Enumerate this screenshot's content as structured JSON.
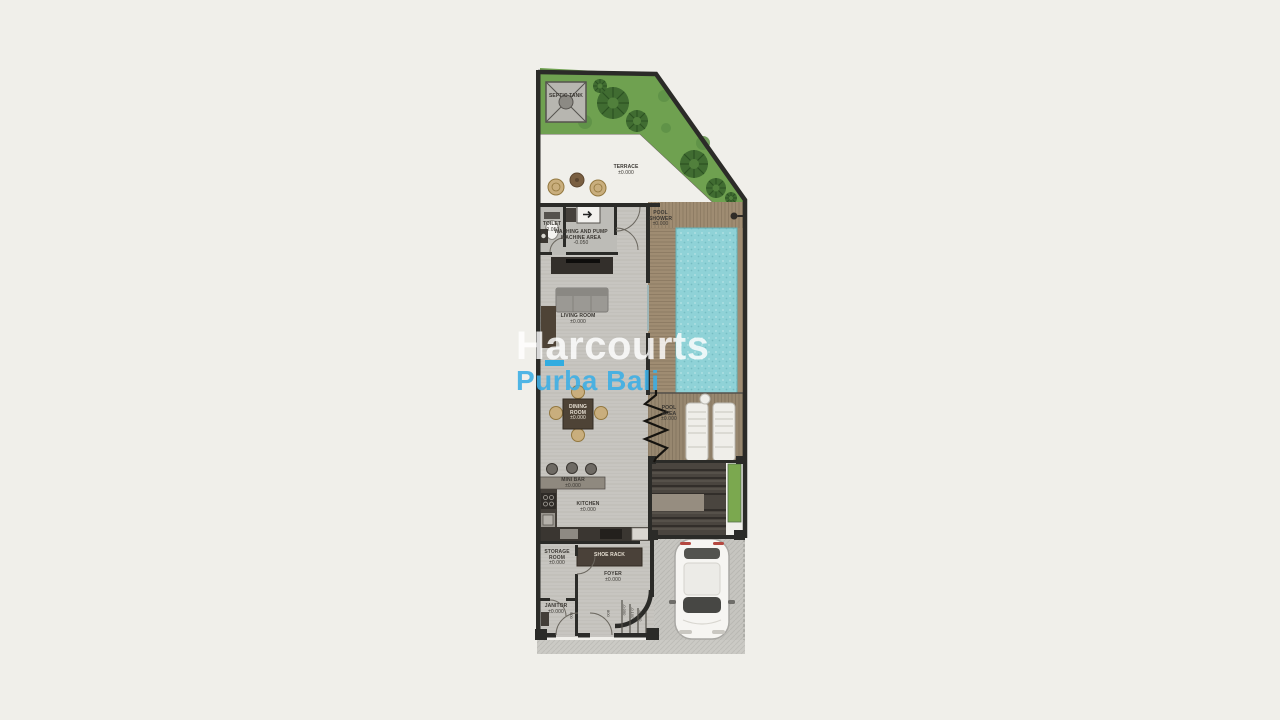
{
  "watermark": {
    "brand": "Harcourts",
    "region": "Purba Bali",
    "accent_color": "#29ABE2",
    "brand_text_color": "#FFFFFF"
  },
  "plan": {
    "rooms": {
      "septic_tank": {
        "name": "SEPTIC TANK",
        "level": ""
      },
      "terrace": {
        "name": "TERRACE",
        "level": "±0.000"
      },
      "toilet": {
        "name": "TOILET",
        "level": "-0.050"
      },
      "washing": {
        "name": "WASHING AND PUMP MACHINE AREA",
        "level": "-0.050"
      },
      "pool_shower": {
        "name": "POOL SHOWER",
        "level": "±0.000"
      },
      "living_room": {
        "name": "LIVING ROOM",
        "level": "±0.000"
      },
      "dining_room": {
        "name": "DINING ROOM",
        "level": "±0.000"
      },
      "pool_area": {
        "name": "POOL AREA",
        "level": "±0.000"
      },
      "mini_bar": {
        "name": "MINI BAR",
        "level": "±0.000"
      },
      "kitchen": {
        "name": "KITCHEN",
        "level": "±0.000"
      },
      "storage_room": {
        "name": "STORAGE ROOM",
        "level": "±0.000"
      },
      "shoe_rack": {
        "name": "SHOE RACK",
        "level": ""
      },
      "foyer": {
        "name": "FOYER",
        "level": "±0.000"
      },
      "janitor": {
        "name": "JANITOR",
        "level": "±0.000"
      }
    },
    "dimensions": {
      "door_left": "900",
      "door_right": "800",
      "step_1": "-0.050",
      "step_2": "-0.100",
      "step_3": "-0.150"
    },
    "colors": {
      "pool_water": "#8FD2D7",
      "garden": "#6FA150",
      "deck_wood": "#A6947C",
      "background": "#F0EFEA"
    }
  }
}
